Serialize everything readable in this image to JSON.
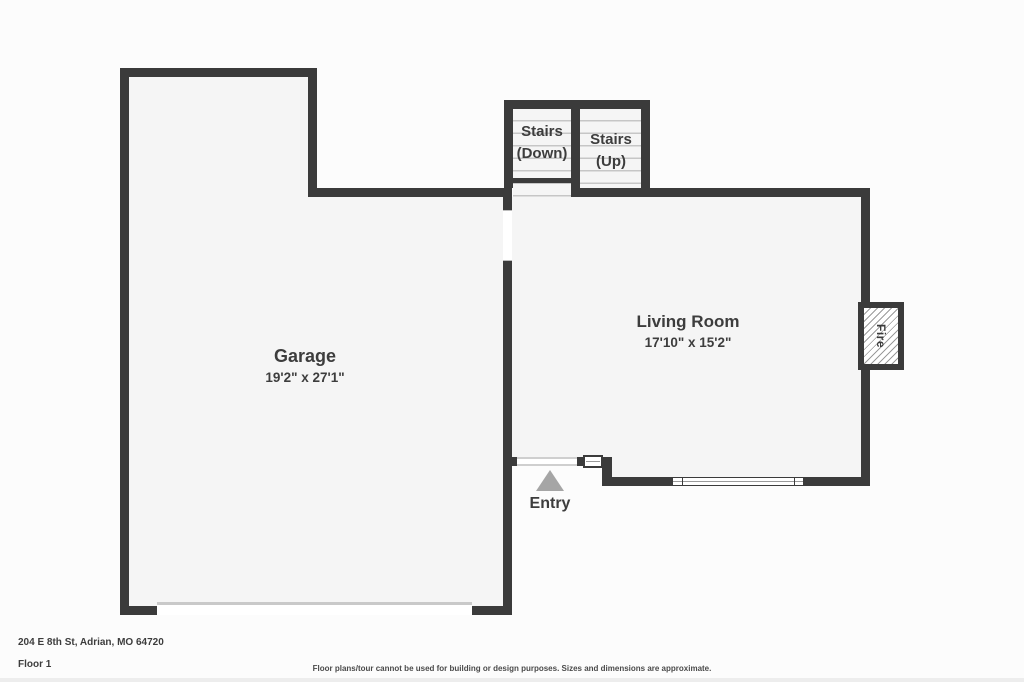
{
  "plan": {
    "rooms": [
      {
        "name": "Garage",
        "dims": "19'2\" x 27'1\""
      },
      {
        "name": "Living Room",
        "dims": "17'10\" x 15'2\""
      }
    ],
    "stairs_down": {
      "line1": "Stairs",
      "line2": "(Down)"
    },
    "stairs_up": {
      "line1": "Stairs",
      "line2": "(Up)"
    },
    "entry_label": "Entry",
    "fireplace_label": "Fire"
  },
  "footer": {
    "address": "204 E 8th St, Adrian, MO 64720",
    "floor": "Floor 1",
    "disclaimer": "Floor plans/tour cannot be used for building or design purposes. Sizes and dimensions are approximate."
  },
  "colors": {
    "wall": "#3b3b3b",
    "floor": "#f5f5f5",
    "stair_tread": "#c6c6c6",
    "entry_triangle": "#a5a5a5",
    "label_text": "#3d3d3d",
    "footer_strip": "#ededed"
  }
}
